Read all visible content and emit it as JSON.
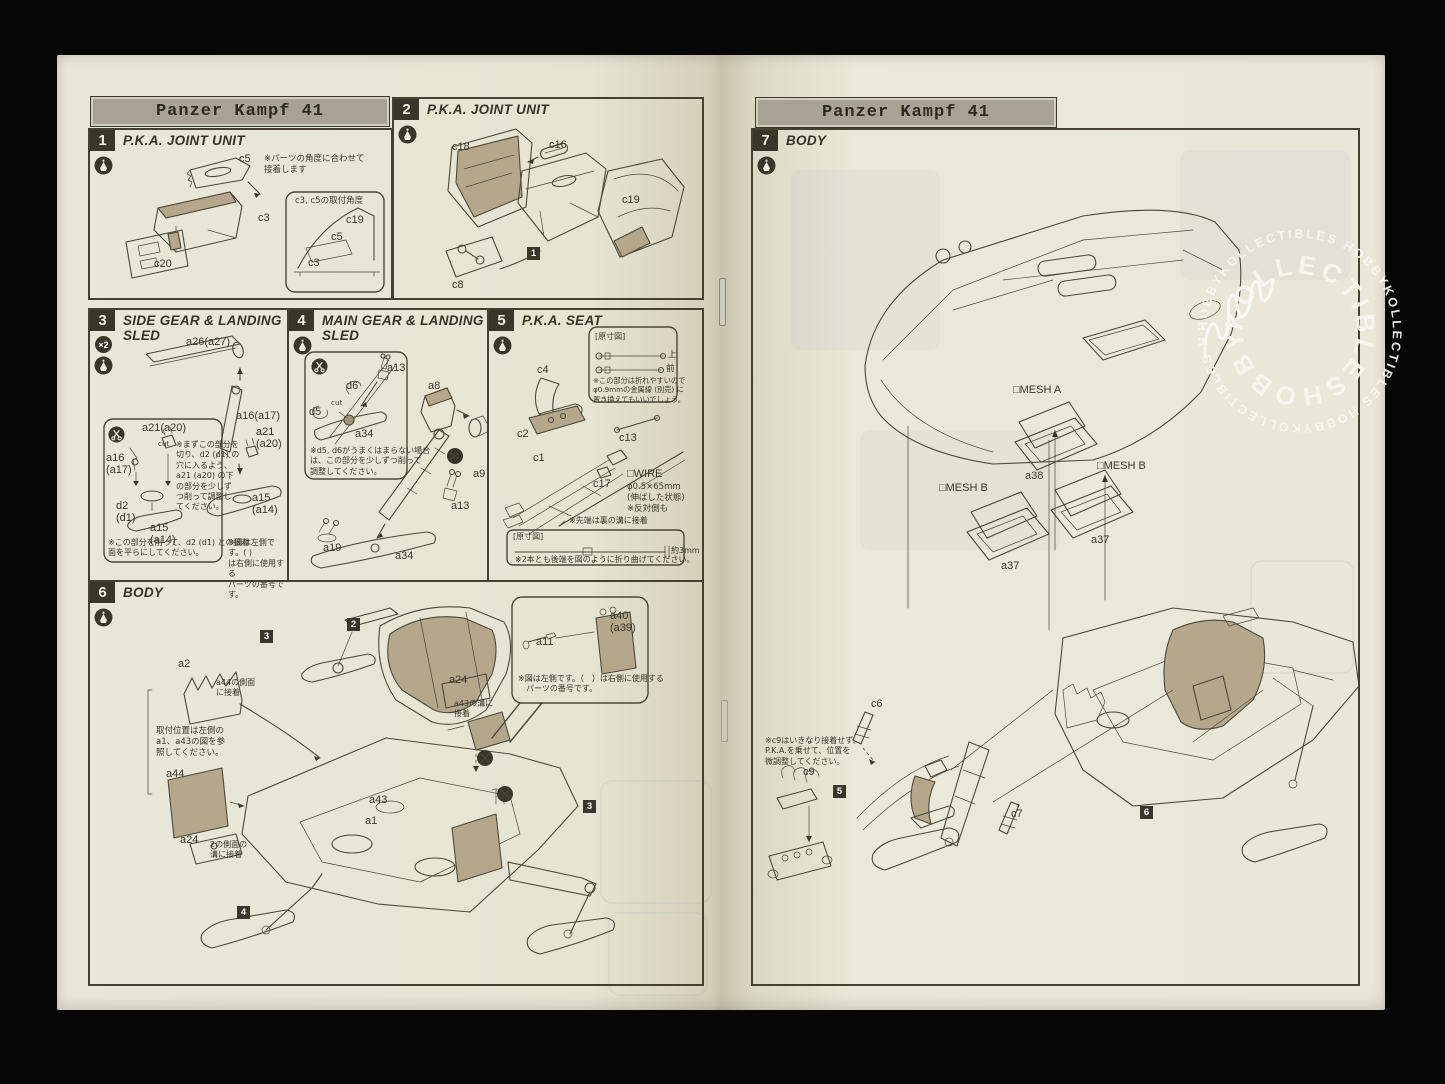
{
  "banner_title": "Panzer Kampf 41",
  "watermark": {
    "outer": "HOBBYKOLLECTIBLES HOBBYKOLLECTIBLES HOBBYKOLLECTIBLES HO",
    "inner": "KOLLECTIBLESHOBBYK"
  },
  "icons": {
    "multiplier": "×2"
  },
  "left": {
    "step1": {
      "num": "1",
      "title": "P.K.A. JOINT UNIT",
      "note": "※パーツの角度に合わせて\n接着します",
      "c5": "c5",
      "c3": "c3",
      "c20": "c20",
      "inset": {
        "title": "c3, c5の取付角度",
        "c19": "c19",
        "c5": "c5",
        "c3": "c3"
      }
    },
    "step2": {
      "num": "2",
      "title": "P.K.A. JOINT UNIT",
      "c18": "c18",
      "c16": "c16",
      "c19": "c19",
      "c8": "c8",
      "ref1": "1"
    },
    "step3": {
      "num": "3",
      "title": "SIDE GEAR & LANDING SLED",
      "a26": "a26(a27)",
      "a16": "a16(a17)",
      "a21": "a21\n(a20)",
      "a15": "a15\n(a14)",
      "side_note": "※図は左側です。( )\nは右側に使用する\nパーツの番号です。",
      "inset": {
        "a16": "a16\n(a17)",
        "a21": "a21(a20)",
        "cut": "cut",
        "d2": "d2\n(d1)",
        "a15": "a15\n(a14)",
        "note": "※まずこの部分を\n切り、d2 (d1) の\n穴に入るよう、\na21 (a20) の下\nの部分を少しず\nつ削って調整し\nてください。",
        "bottom_note": "※この部分を削って、d2 (d1) との接着\n面を平らにしてください。"
      }
    },
    "step4": {
      "num": "4",
      "title": "MAIN GEAR & LANDING SLED",
      "a8": "a8",
      "a9": "a9",
      "a13": "a13",
      "a19": "a19",
      "a34": "a34",
      "inset": {
        "d5": "d5",
        "d6": "d6",
        "cut": "cut",
        "a13": "a13",
        "a34": "a34",
        "note": "※d5, d6がうまくはまらない場合\nは、この部分を少しずつ削って\n調整してください。"
      }
    },
    "step5": {
      "num": "5",
      "title": "P.K.A. SEAT",
      "c4": "c4",
      "c2": "c2",
      "c13": "c13",
      "c1": "c1",
      "c17": "c17",
      "wire_title": "□WIRE",
      "wire_spec": "φ0.5×65mm\n(伸ばした状態)\n※反対側も",
      "tip_note": "※先端は裏の溝に接着",
      "inset1": {
        "title": "[原寸図]",
        "up": "上",
        "front": "前",
        "note": "※この部分は折れやすいので\nφ0.9mmの金属線 (別売) に\n置き換えてもいいでしょう。"
      },
      "inset2": {
        "title": "[原寸図]",
        "dim": "約3mm",
        "note": "※2本とも後端を図のように折り曲げてください。"
      }
    },
    "step6": {
      "num": "6",
      "title": "BODY",
      "a2": "a2",
      "a44": "a44",
      "a24l": "a24",
      "a43": "a43",
      "a1": "a1",
      "a24r": "a24",
      "ref3a": "3",
      "ref2": "2",
      "ref4": "4",
      "ref3b": "3",
      "note_a44": "a44の側面\nに接着",
      "note_pos": "取付位置は左側の\na1、a43の図を参\n照してください。",
      "note_groove2": "2の側面の\n溝に接着",
      "note_groove43": "a43の溝に\n接着",
      "inset": {
        "a11": "a11",
        "a40": "a40\n(a39)",
        "note": "※図は左側です。（　）は右側に使用する\n　パーツの番号です。"
      }
    }
  },
  "right": {
    "step7": {
      "num": "7",
      "title": "BODY",
      "meshA": "□MESH A",
      "a38": "a38",
      "meshB1": "□MESH B",
      "a37a": "a37",
      "meshB2": "□MESH B",
      "a37b": "a37",
      "c6": "c6",
      "c9": "c9",
      "c7": "c7",
      "ref5": "5",
      "ref6": "6",
      "note_c9": "※c9はいきなり接着せず、\nP.K.A.を乗せて、位置を\n微調整してください。"
    }
  }
}
